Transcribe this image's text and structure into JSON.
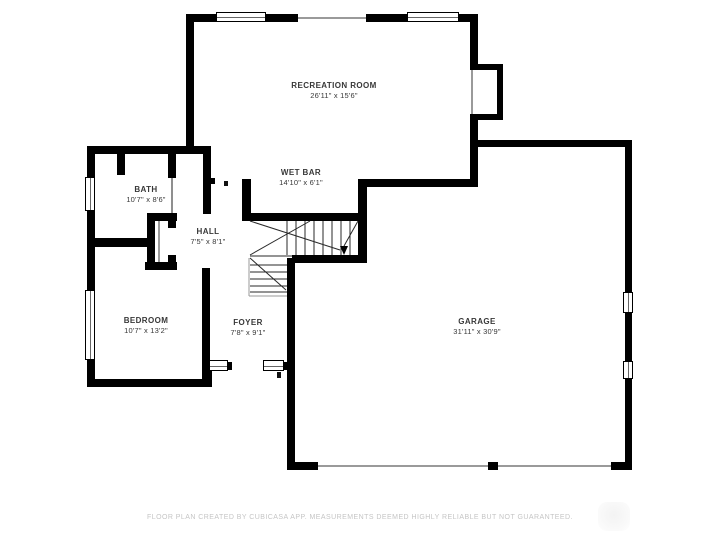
{
  "plan": {
    "rooms": [
      {
        "name": "RECREATION ROOM",
        "dims": "26'11\" x 15'6\""
      },
      {
        "name": "WET BAR",
        "dims": "14'10\" x 6'1\""
      },
      {
        "name": "BATH",
        "dims": "10'7\" x 8'6\""
      },
      {
        "name": "HALL",
        "dims": "7'5\" x 8'1\""
      },
      {
        "name": "BEDROOM",
        "dims": "10'7\" x 13'2\""
      },
      {
        "name": "FOYER",
        "dims": "7'8\" x 9'1\""
      },
      {
        "name": "GARAGE",
        "dims": "31'11\" x 30'9\""
      }
    ],
    "footer": "FLOOR PLAN CREATED BY CUBICASA APP. MEASUREMENTS DEEMED HIGHLY RELIABLE BUT NOT GUARANTEED.",
    "colors": {
      "wall": "#000000",
      "label": "#383838",
      "footer": "#c5c5c5"
    }
  }
}
